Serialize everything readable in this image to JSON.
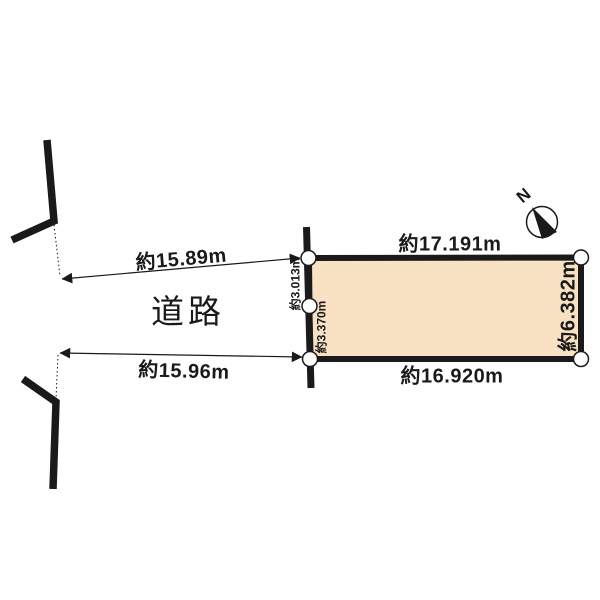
{
  "diagram": {
    "type": "land-plot-survey",
    "road_label": "道路",
    "compass": {
      "north_label": "N"
    },
    "plot": {
      "edge_top": "約17.191m",
      "edge_bottom": "約16.920m",
      "edge_right": "約6.382m",
      "edge_left_upper": "約3.013m",
      "edge_left_lower": "約3.370m"
    },
    "road_frontage": {
      "upper": "約15.89m",
      "lower": "約15.96m"
    },
    "colors": {
      "plot_fill": "#F8E2C3",
      "line": "#1A1A1A",
      "background": "#FFFFFF"
    }
  }
}
